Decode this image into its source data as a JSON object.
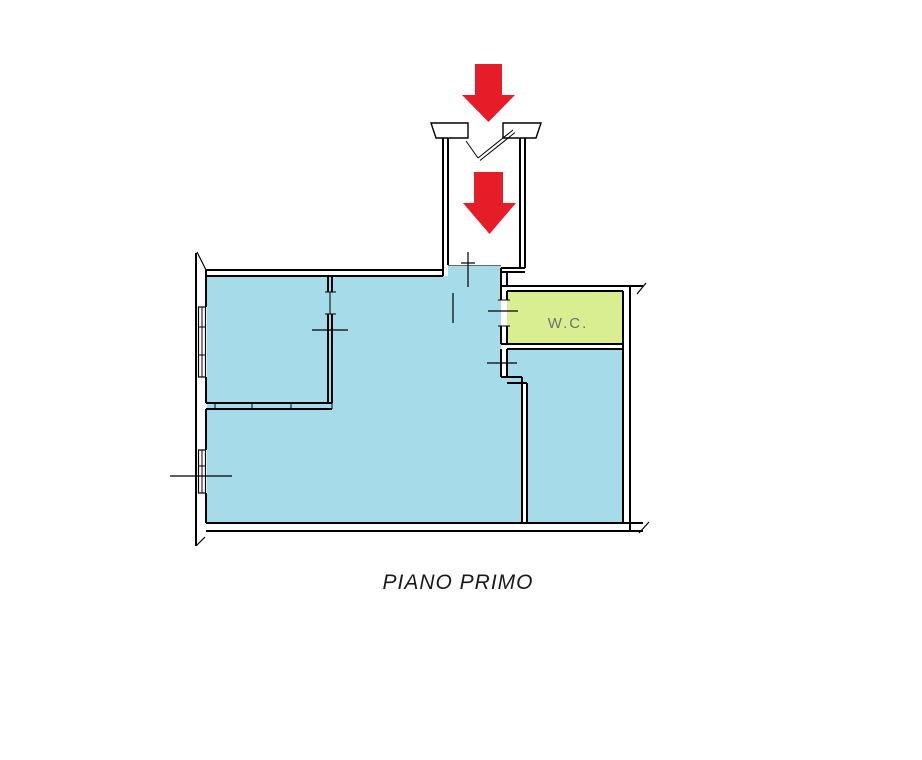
{
  "caption": {
    "text": "PIANO PRIMO"
  },
  "rooms": {
    "wc": {
      "label": "W.C.",
      "fill": "#d9ee90"
    },
    "main": {
      "fill": "#a6dce9"
    }
  },
  "icons": {
    "entrance_arrow_upper": "red-down-arrow",
    "entrance_arrow_lower": "red-down-arrow"
  },
  "colors": {
    "walls": "#000000",
    "arrow": "#e61d28",
    "wc_label_text": "#6f6f6f",
    "caption_text": "#1a1a1a",
    "background": "#ffffff"
  }
}
